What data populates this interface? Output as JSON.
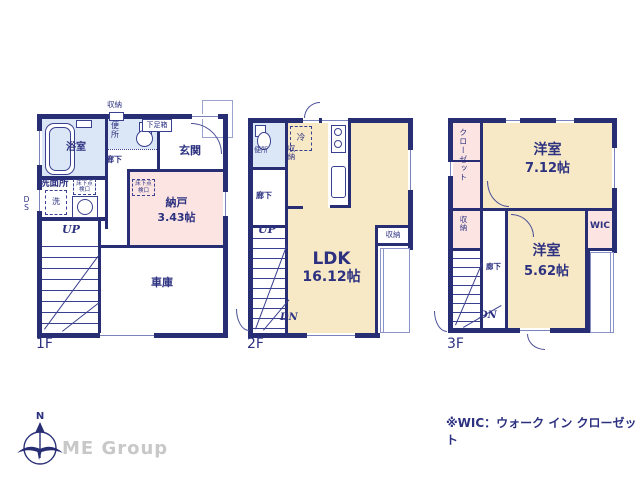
{
  "colors": {
    "wall_navy": "#282e74",
    "text_navy": "#2c3180",
    "room_cream": "#f8e9c6",
    "room_pink": "#fbe4e2",
    "room_blue": "#dbe7f6",
    "thin_line": "#8a93c9",
    "logo_gray": "#c8c8c8"
  },
  "floor1": {
    "label": "1F",
    "bath": "浴室",
    "washroom": "洗面所",
    "washer": "洗",
    "toilet": "便所",
    "hall": "廊下",
    "entrance": "玄関",
    "shoe_box": "下足箱",
    "storage_top": "収納",
    "underfloor_hatch1": "床下点検口",
    "underfloor_hatch2": "床下点検口",
    "storeroom": "納戸",
    "storeroom_size": "3.43帖",
    "garage": "車庫",
    "stairs_up": "UP",
    "duct": "DS"
  },
  "floor2": {
    "label": "2F",
    "toilet": "便所",
    "hall": "廊下",
    "fridge": "冷",
    "storage_left": "収納",
    "ldk": "LDK",
    "ldk_size": "16.12帖",
    "storage_right": "収納",
    "stairs_up": "UP",
    "stairs_down": "DN"
  },
  "floor3": {
    "label": "3F",
    "closet": "クローゼット",
    "room1": "洋室",
    "room1_size": "7.12帖",
    "storage": "収納",
    "hall": "廊下",
    "wic": "WIC",
    "room2": "洋室",
    "room2_size": "5.62帖",
    "stairs_down": "DN"
  },
  "footer": {
    "note": "※WIC：ウォーク イン クローゼット",
    "compass_n": "N",
    "logo": "ME Group"
  }
}
